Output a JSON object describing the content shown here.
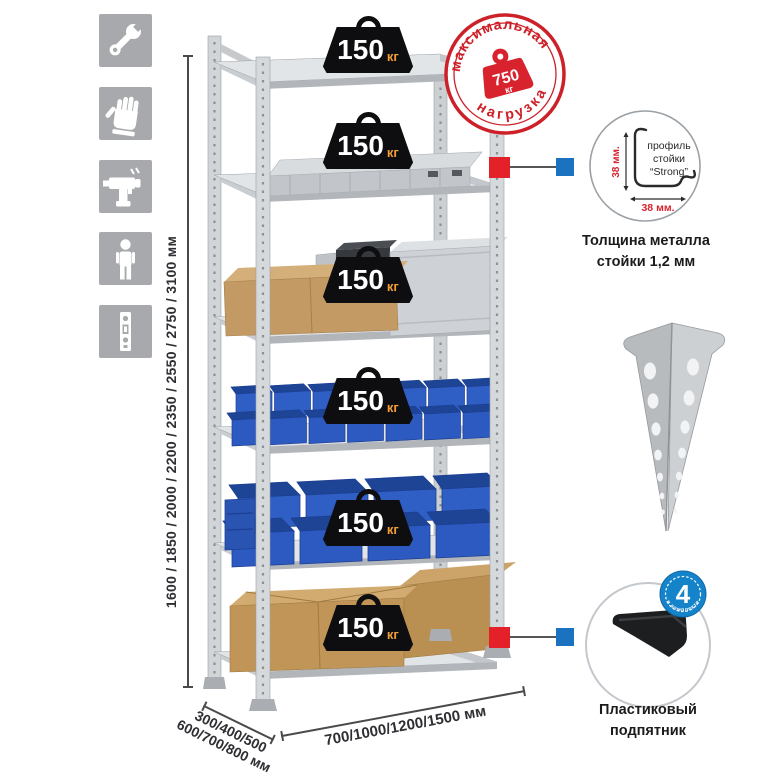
{
  "infographic": {
    "icons": [
      "wrench",
      "work-gloves",
      "drill",
      "person-height",
      "rack-post"
    ],
    "height_options_label": "1600 / 1850 / 2000 / 2200 / 2350 / 2550 / 2750 / 3100 мм",
    "depth_options_line1": "300/400/500",
    "depth_options_line2": "600/700/800 мм",
    "width_options_label": "700/1000/1200/1500 мм",
    "shelf_loads": [
      {
        "value": "150",
        "unit": "кг"
      },
      {
        "value": "150",
        "unit": "кг"
      },
      {
        "value": "150",
        "unit": "кг"
      },
      {
        "value": "150",
        "unit": "кг"
      },
      {
        "value": "150",
        "unit": "кг"
      },
      {
        "value": "150",
        "unit": "кг"
      }
    ],
    "max_load_stamp": {
      "arc_top": "максимальная",
      "arc_bottom": "нагрузка",
      "value": "750",
      "unit": "кг"
    },
    "profile_detail": {
      "dim_vertical": "38 мм.",
      "dim_horizontal": "38 мм.",
      "label_line1": "профиль",
      "label_line2": "стойки",
      "label_line3": "“Strong”",
      "caption_line1": "Толщина металла",
      "caption_line2": "стойки 1,2 мм"
    },
    "foot_detail": {
      "badge_count": "4",
      "badge_text": "в комплекте",
      "caption_line1": "Пластиковый",
      "caption_line2": "подпятник"
    },
    "colors": {
      "accent_red": "#cd2129",
      "accent_blue": "#1a72c0",
      "badge_black": "#0e0e10",
      "unit_orange": "#f29d38",
      "bin_blue": "#2f5fc4",
      "metal_gray": "#d6d9dc"
    }
  }
}
